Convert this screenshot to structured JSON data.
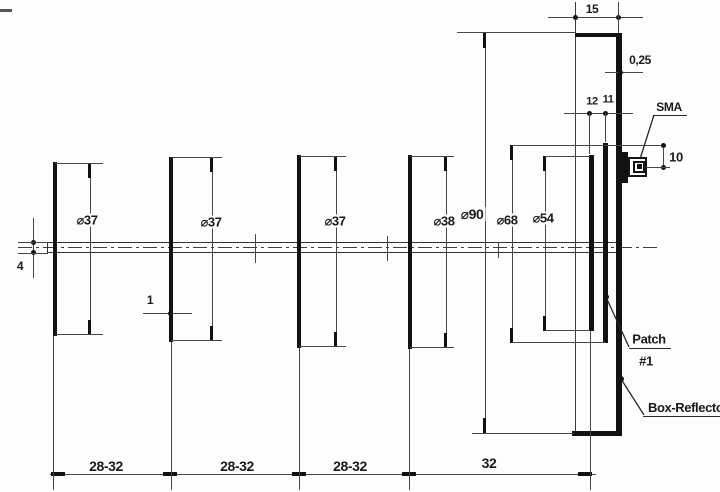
{
  "drawing": {
    "diameters": {
      "director1": "⌀37",
      "director2": "⌀37",
      "director3": "⌀37",
      "director4": "⌀38",
      "reflector": "⌀90",
      "patch1": "⌀68",
      "patch2": "⌀54"
    },
    "spacings": {
      "s1": "28-32",
      "s2": "28-32",
      "s3": "28-32",
      "s4": "32"
    },
    "dims": {
      "reflector_depth": "15",
      "wall_thickness": "0,25",
      "gap12": "12",
      "gap11": "11",
      "feed_height": "10",
      "boom_diameter": "4",
      "disc_thickness": "1"
    },
    "callouts": {
      "sma": "SMA",
      "patch": "Patch",
      "patch_number": "#1",
      "box_reflector": "Box-Reflector"
    },
    "colors": {
      "line": "#121212",
      "dim_line": "#474747",
      "background": "#fdfdfd"
    }
  }
}
